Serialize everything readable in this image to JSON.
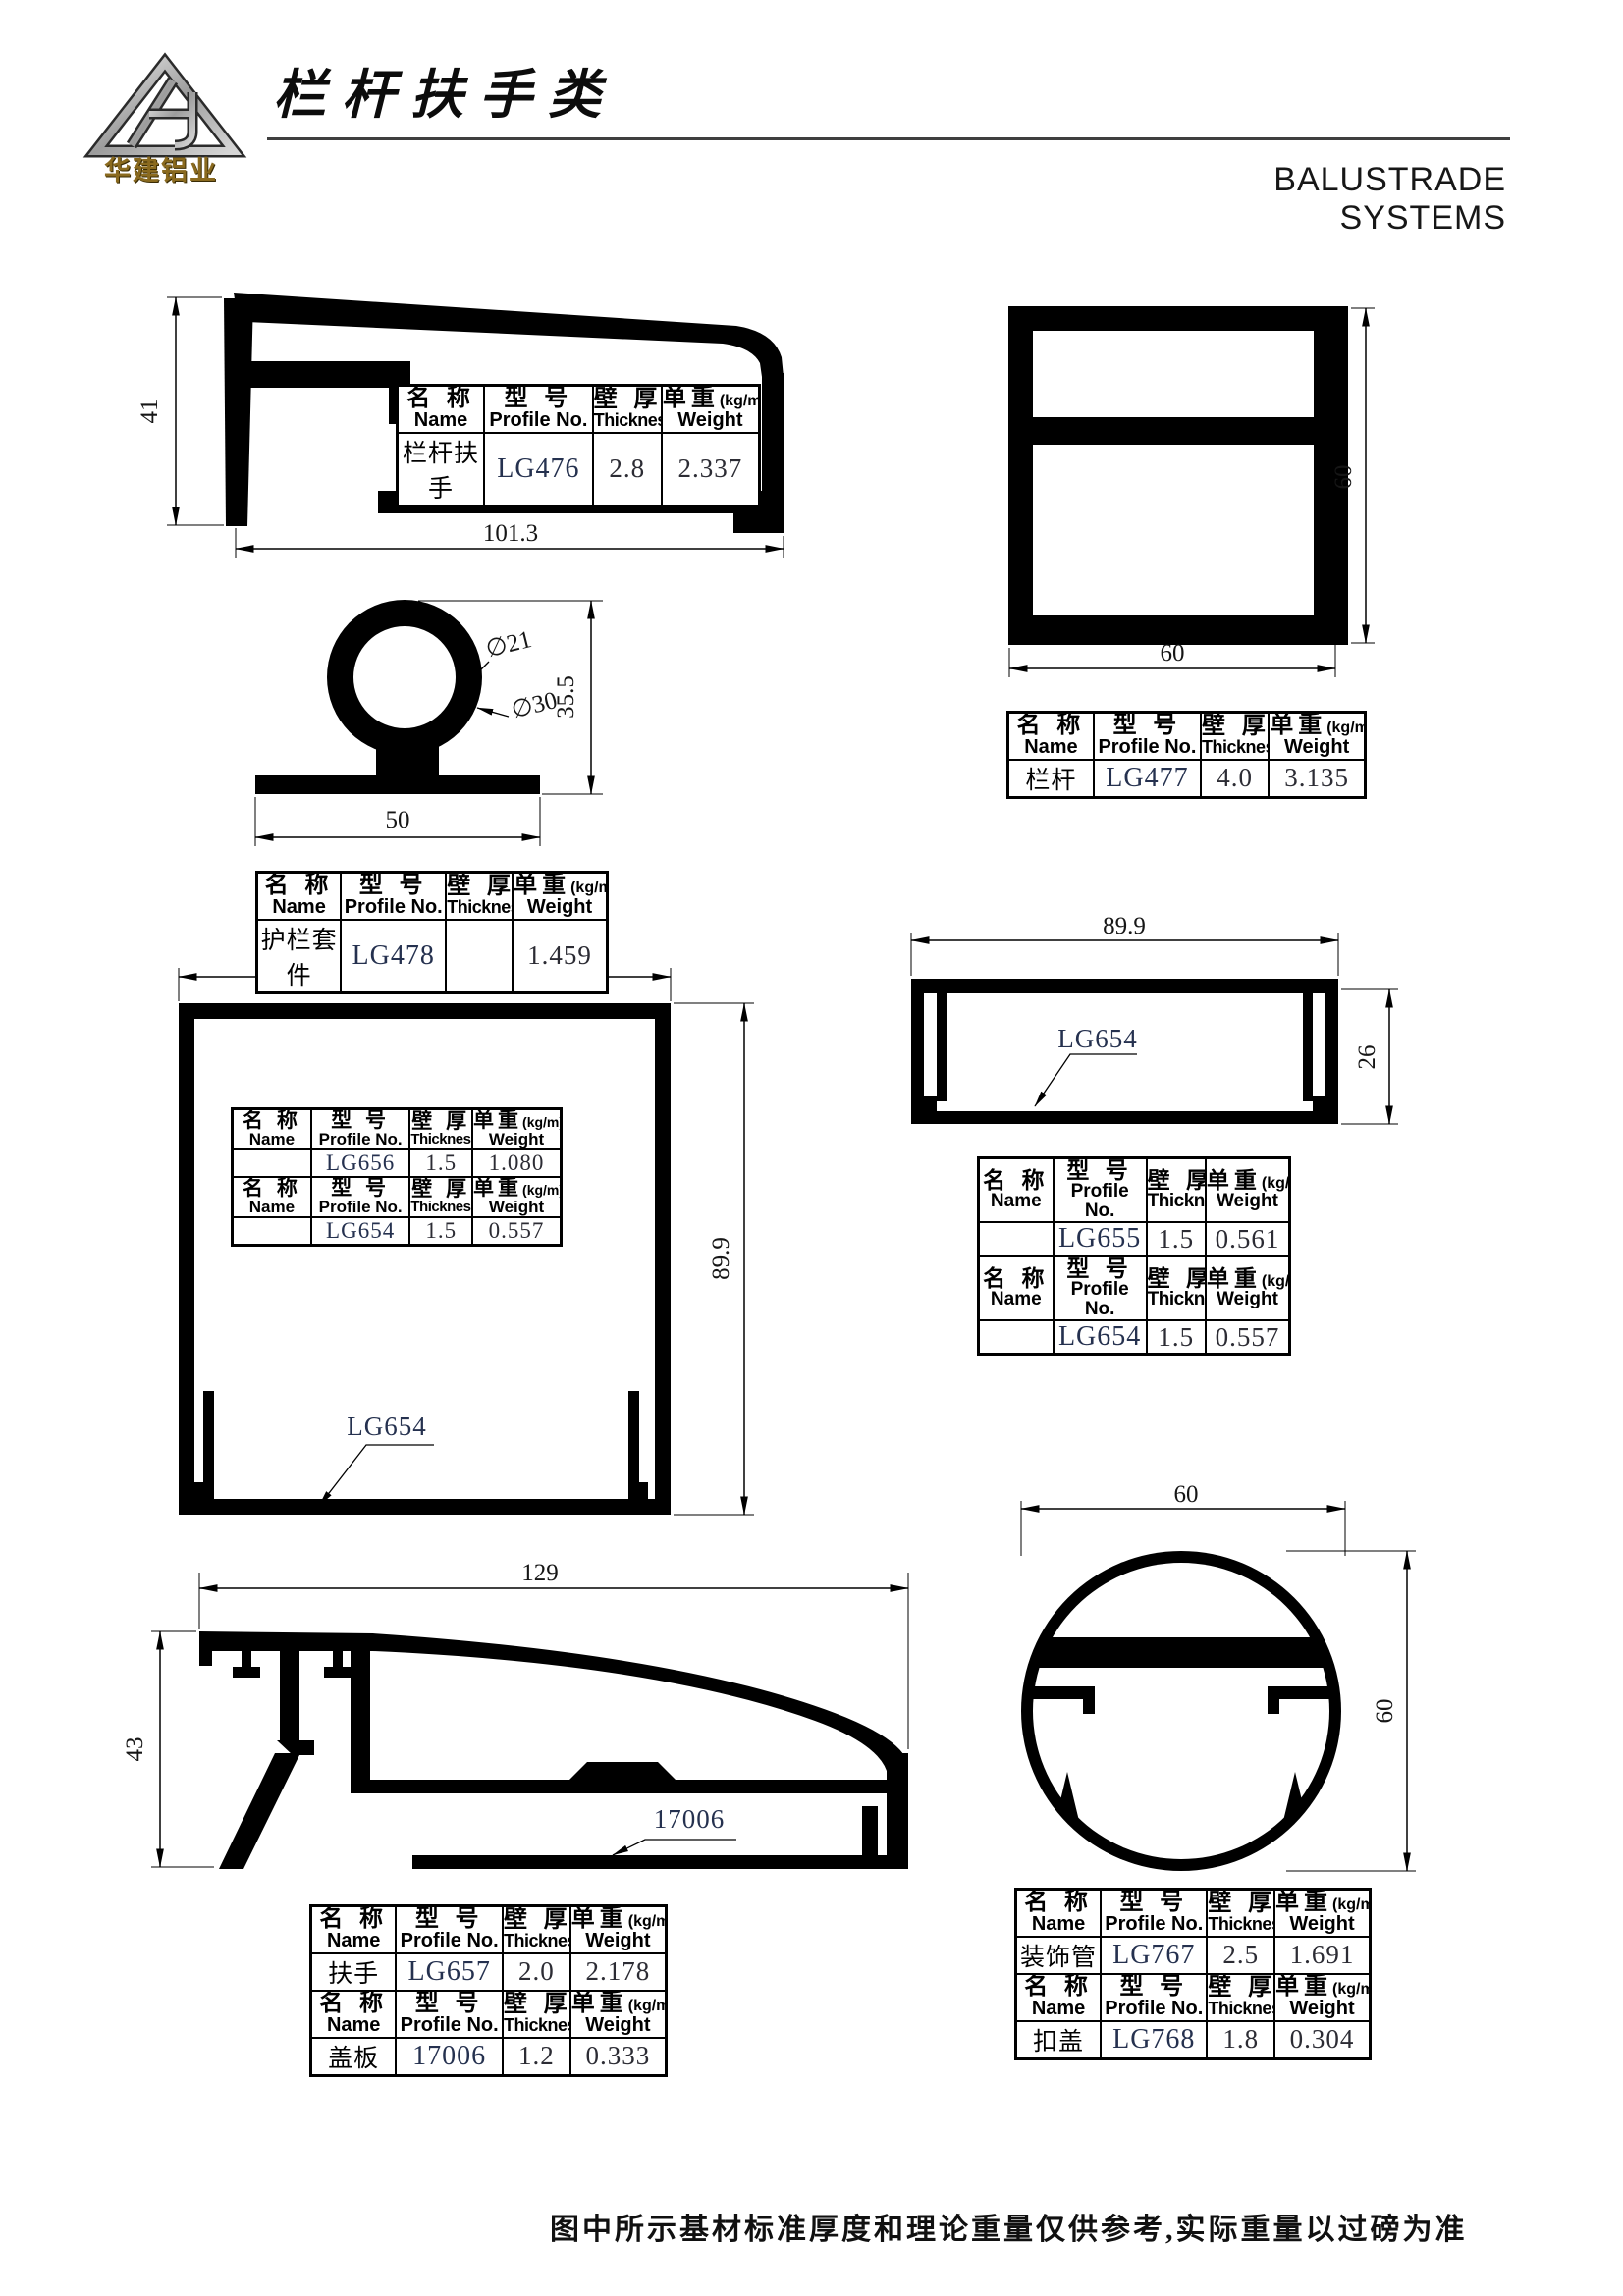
{
  "page": {
    "logo_text": "华建铝业",
    "title_cn": "栏杆扶手类",
    "title_en": "BALUSTRADE SYSTEMS",
    "footer_note": "图中所示基材标准厚度和理论重量仅供参考,实际重量以过磅为准"
  },
  "th": {
    "name_cn": "名 称",
    "name_en": "Name",
    "profile_cn": "型 号",
    "profile_en": "Profile No.",
    "thickness_cn": "壁 厚",
    "thickness_en": "Thickness",
    "weight_cn": "单重",
    "weight_unit": "(kg/m)",
    "weight_en": "Weight"
  },
  "drawings": {
    "rail_lg476": {
      "dim_height": "41",
      "dim_width": "101.3",
      "row": {
        "name": "栏杆扶手",
        "no": "LG476",
        "thickness": "2.8",
        "weight": "2.337"
      }
    },
    "sleeve_lg478": {
      "dia_inner": "∅21",
      "dia_outer": "∅30",
      "dim_height": "35.5",
      "dim_width": "50",
      "row": {
        "name": "护栏套件",
        "no": "LG478",
        "thickness": "",
        "weight": "1.459"
      }
    },
    "post_lg477": {
      "dim_width": "60",
      "dim_height": "60",
      "row": {
        "name": "栏杆",
        "no": "LG477",
        "thickness": "4.0",
        "weight": "3.135"
      }
    },
    "box_lg656": {
      "dim_width": "89.9",
      "dim_height": "89.9",
      "callout": "LG654",
      "rows": [
        {
          "name": "",
          "no": "LG656",
          "thickness": "1.5",
          "weight": "1.080"
        },
        {
          "name": "",
          "no": "LG654",
          "thickness": "1.5",
          "weight": "0.557"
        }
      ]
    },
    "channel_lg655": {
      "dim_width": "89.9",
      "dim_height": "26",
      "callout": "LG654",
      "rows": [
        {
          "name": "",
          "no": "LG655",
          "thickness": "1.5",
          "weight": "0.561"
        },
        {
          "name": "",
          "no": "LG654",
          "thickness": "1.5",
          "weight": "0.557"
        }
      ]
    },
    "rail_lg657": {
      "dim_width": "129",
      "dim_height": "43",
      "callout": "17006",
      "rows": [
        {
          "name": "扶手",
          "no": "LG657",
          "thickness": "2.0",
          "weight": "2.178"
        },
        {
          "name": "盖板",
          "no": "17006",
          "thickness": "1.2",
          "weight": "0.333"
        }
      ]
    },
    "tube_lg767": {
      "dim_width": "60",
      "dim_height": "60",
      "rows": [
        {
          "name": "装饰管",
          "no": "LG767",
          "thickness": "2.5",
          "weight": "1.691"
        },
        {
          "name": "扣盖",
          "no": "LG768",
          "thickness": "1.8",
          "weight": "0.304"
        }
      ]
    }
  },
  "colors": {
    "ink": "#000000",
    "profile_no_ink": "#25314f",
    "logo_gold": "#8a6a1f",
    "rule_gray": "#3f3f3f"
  }
}
